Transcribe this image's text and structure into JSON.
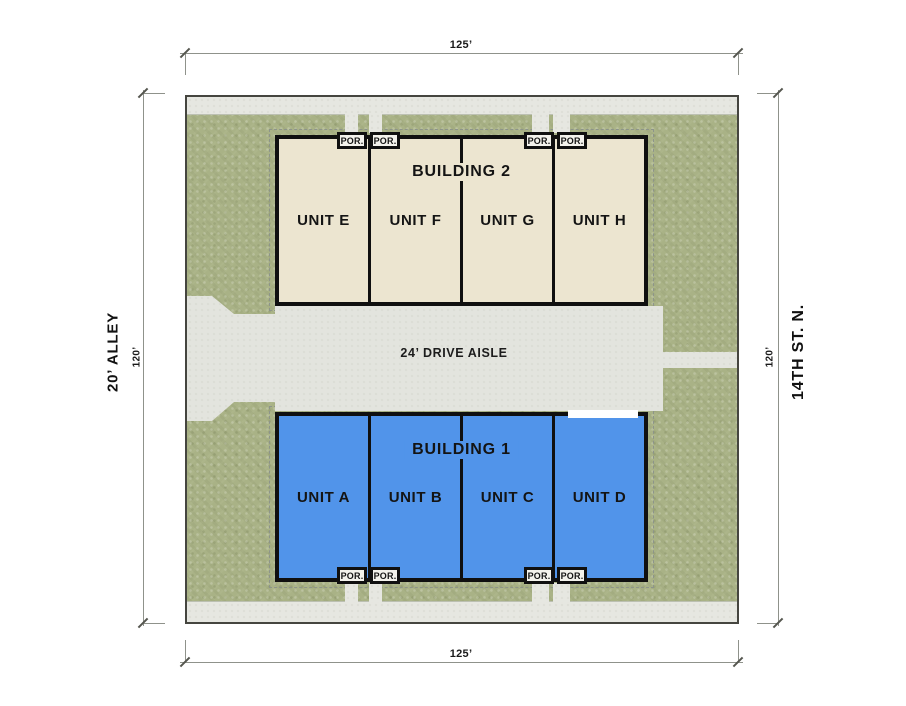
{
  "plan": {
    "title_context": "townhome site plan",
    "dimensions": {
      "top": "125’",
      "bottom": "125’",
      "left": "120’",
      "right": "120’"
    },
    "streets": {
      "left": "20’ ALLEY",
      "right": "14TH ST. N."
    },
    "drive_aisle_label": "24’ DRIVE AISLE",
    "porch_label": "POR.",
    "buildings": [
      {
        "name": "BUILDING 2",
        "units": [
          "UNIT E",
          "UNIT F",
          "UNIT G",
          "UNIT H"
        ],
        "fill": "#ece5d0"
      },
      {
        "name": "BUILDING 1",
        "units": [
          "UNIT A",
          "UNIT B",
          "UNIT C",
          "UNIT D"
        ],
        "fill": "#5194ea"
      }
    ],
    "colors": {
      "greenspace": "#a9b286",
      "pavement": "#e3e4de",
      "outline": "#101010",
      "building1_fill": "#5194ea",
      "building2_fill": "#ece5d0"
    }
  }
}
